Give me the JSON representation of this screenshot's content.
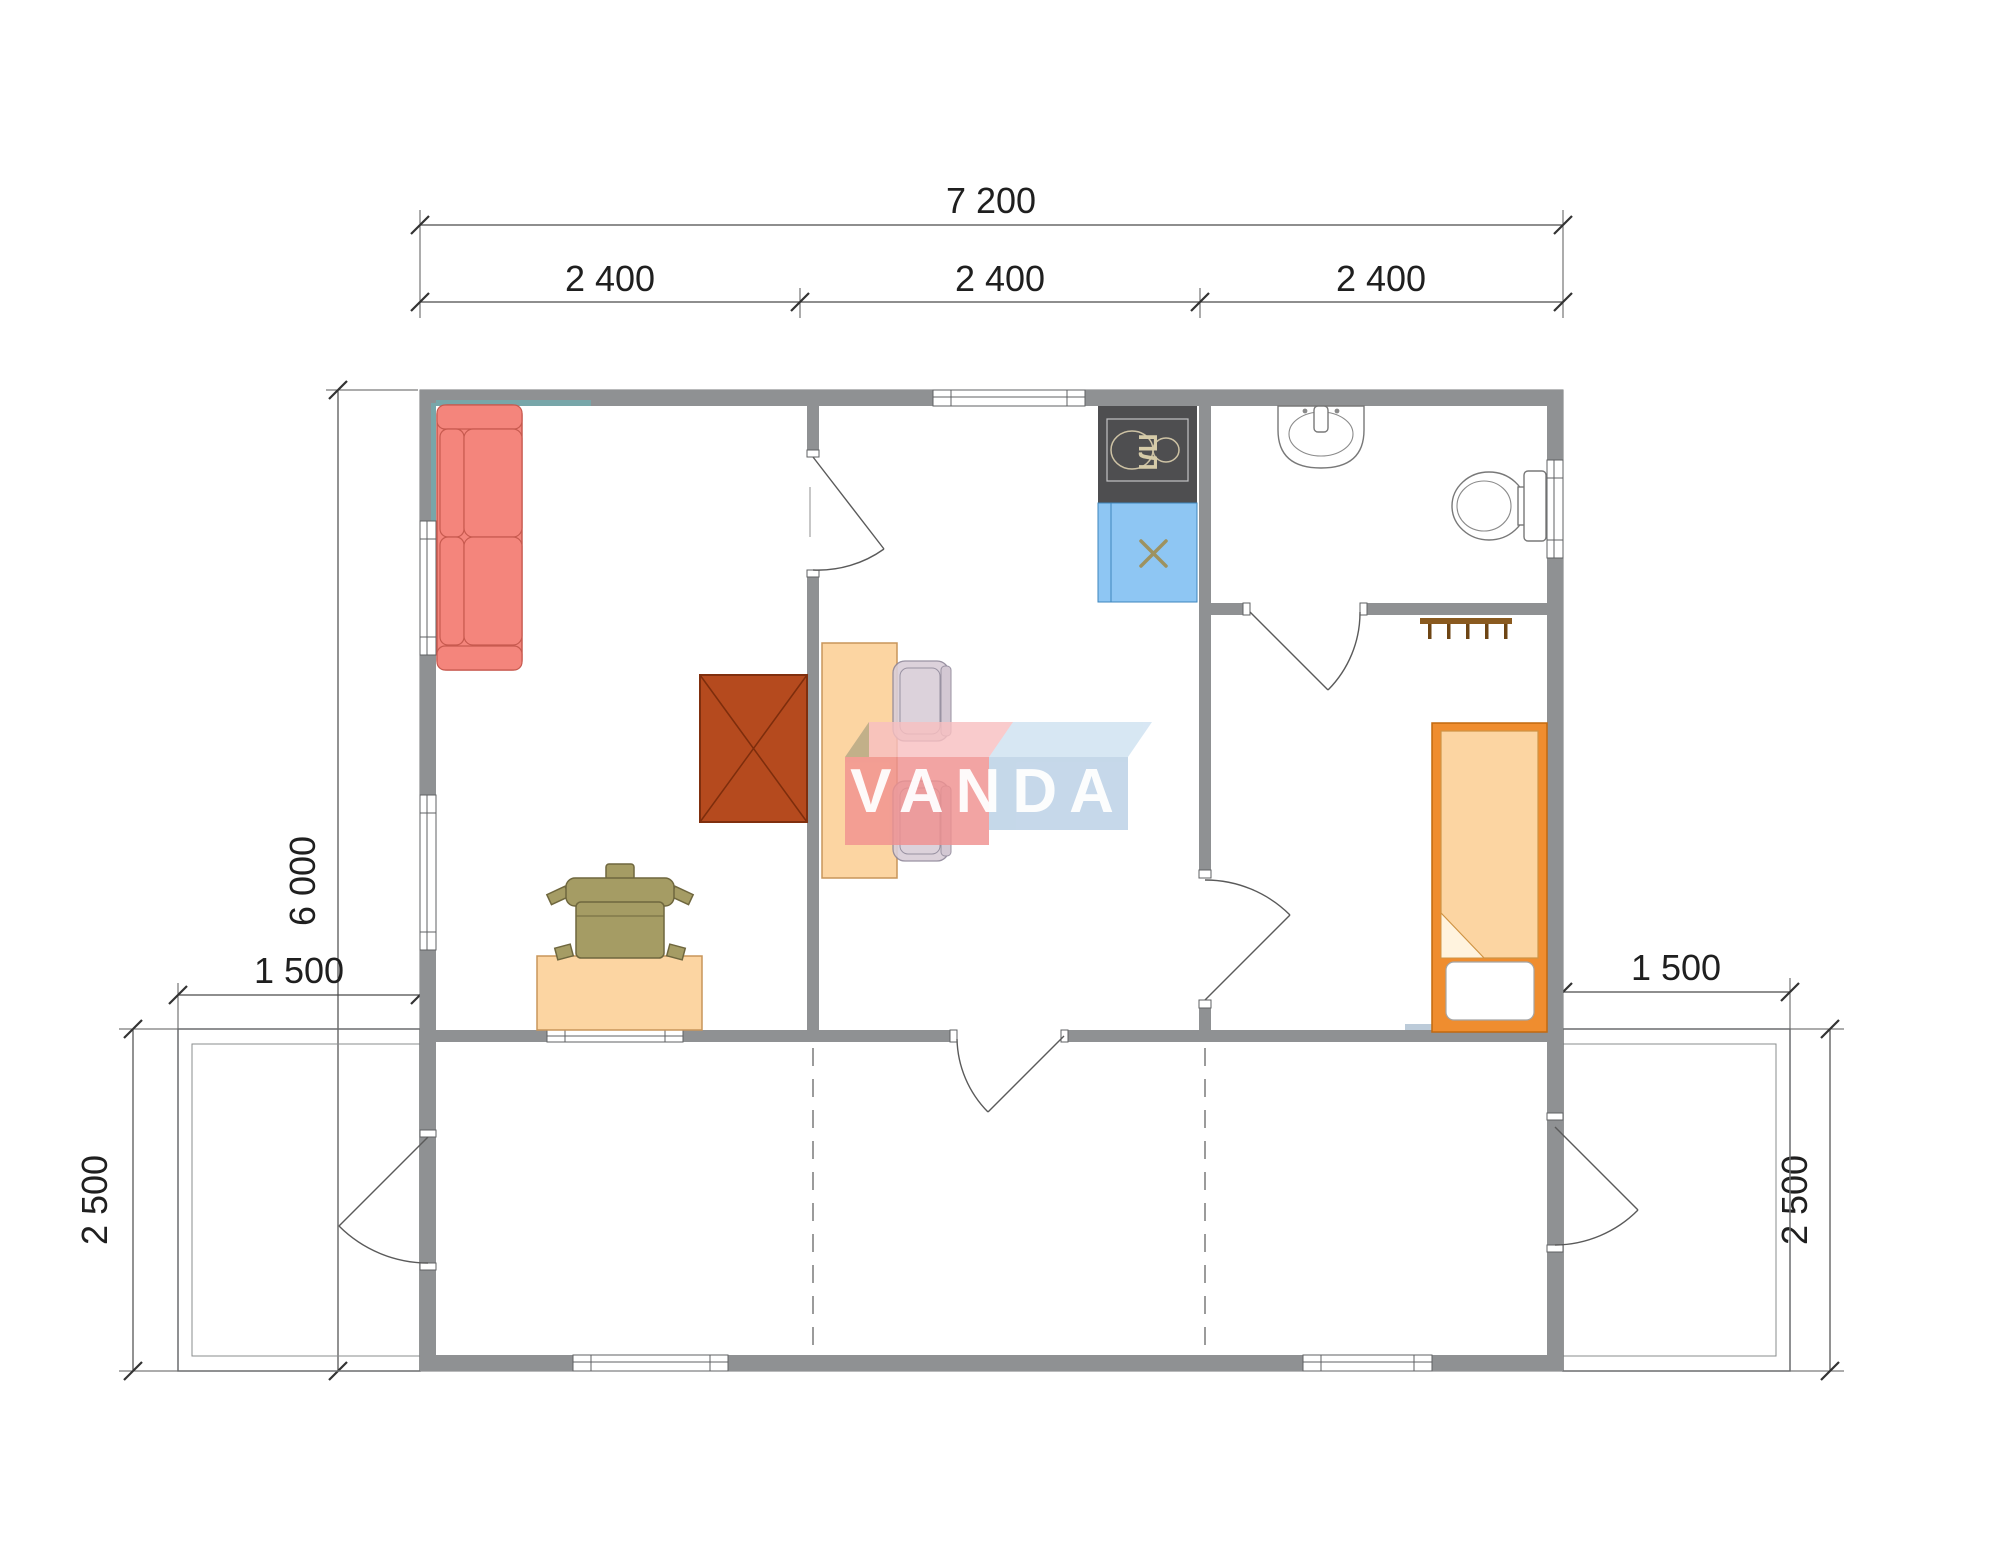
{
  "plan": {
    "type": "floor-plan",
    "watermark": {
      "text": "VANDA",
      "red": "#f09190",
      "red_top": "#f8c0c1",
      "blue": "#b9d0e5",
      "blue_top": "#cfe2f1",
      "text_color": "#ffffff"
    },
    "stove_label": "ПЛ",
    "dimensions": {
      "top_total": "7 200",
      "top_segments": [
        "2 400",
        "2 400",
        "2 400"
      ],
      "side_height": "6 000",
      "terrace_width_left": "1 500",
      "terrace_width_right": "1 500",
      "terrace_depth_left": "2 500",
      "terrace_depth_right": "2 500"
    },
    "colors": {
      "wall": "#8f9193",
      "sofa": "#f4857c",
      "wood_light": "#fcd5a2",
      "wardrobe": "#b54a1e",
      "kitchen_sink": "#8ec6f3",
      "stove": "#4e4e50",
      "bed_frame": "#ef8d2f",
      "desk_chair": "#a59c64",
      "dining_chair": "#d9ced8",
      "shadow_blue": "#8fa9bf",
      "shadow_teal": "#74a9ad",
      "dimension_text": "#1f1f1f"
    }
  }
}
